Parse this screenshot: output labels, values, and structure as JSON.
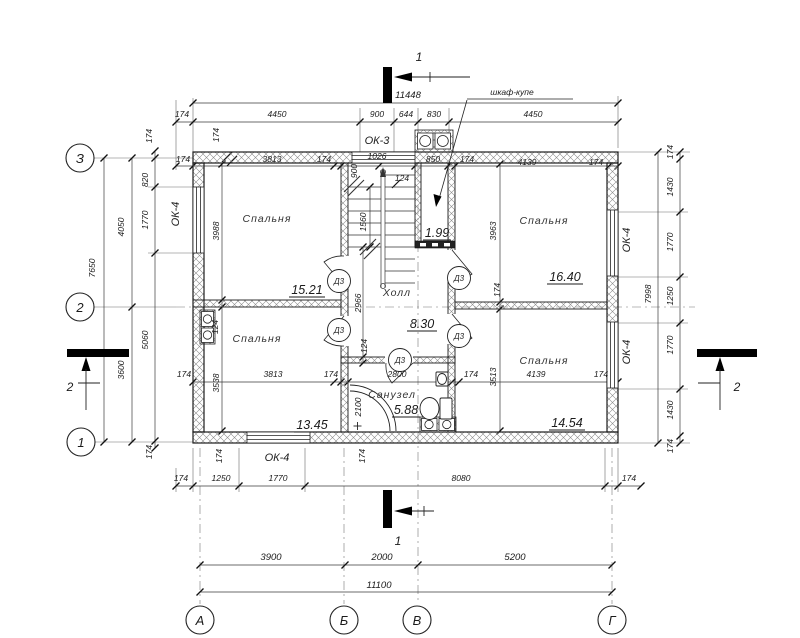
{
  "axes": {
    "rows": [
      "З",
      "2",
      "1"
    ],
    "cols": [
      "А",
      "Б",
      "В",
      "Г"
    ]
  },
  "sections": {
    "s1": "1",
    "s2": "2"
  },
  "rooms": {
    "bedroom_tl": {
      "name": "Спальня",
      "area": "15.21"
    },
    "bedroom_tr": {
      "name": "Спальня",
      "area": "16.40"
    },
    "bedroom_bl": {
      "name": "Спальня",
      "area": "13.45"
    },
    "bedroom_br": {
      "name": "Спальня",
      "area": "14.54"
    },
    "hall": {
      "name": "Холл",
      "area": "8.30"
    },
    "bathroom": {
      "name": "Санузел",
      "area": "5.88"
    },
    "closet": {
      "area": "1.99",
      "callout": "шкаф-купе"
    }
  },
  "labels": {
    "window_ok3": "ОК-3",
    "window_ok4": "ОК-4",
    "door_d3": "Д3"
  },
  "dims": {
    "top_total": "11448",
    "top_row": [
      "174",
      "4450",
      "900",
      "644",
      "830",
      "4450"
    ],
    "inner_top_row": [
      "174",
      "3813",
      "174",
      "1026",
      "850",
      "174",
      "4139",
      "174"
    ],
    "left_outer_total": "7650",
    "left_axis_spans": [
      "4050",
      "3600"
    ],
    "left_inner_chain": [
      "174",
      "820",
      "1770",
      "5060",
      "174"
    ],
    "right_outer_total": "7998",
    "right_inner_chain": [
      "174",
      "1430",
      "1770",
      "1250",
      "1770",
      "1430",
      "174"
    ],
    "bottom_row": [
      "174",
      "1250",
      "1770",
      "8080",
      "174"
    ],
    "bottom_axis_spans": [
      "3900",
      "2000",
      "5200"
    ],
    "bottom_total": "11100",
    "mid_row": [
      "174",
      "3813",
      "174",
      "2800",
      "174",
      "4139",
      "174"
    ],
    "wall_tick": "174",
    "partition_tick": "124",
    "room_tl_h": "3988",
    "room_tr_h": "3963",
    "room_bl_h": "3538",
    "room_br_h": "3513",
    "hall_h": "2966",
    "stair_len": "1560",
    "stair_w": "900",
    "stair_off": "124",
    "shower_w": "2100"
  }
}
